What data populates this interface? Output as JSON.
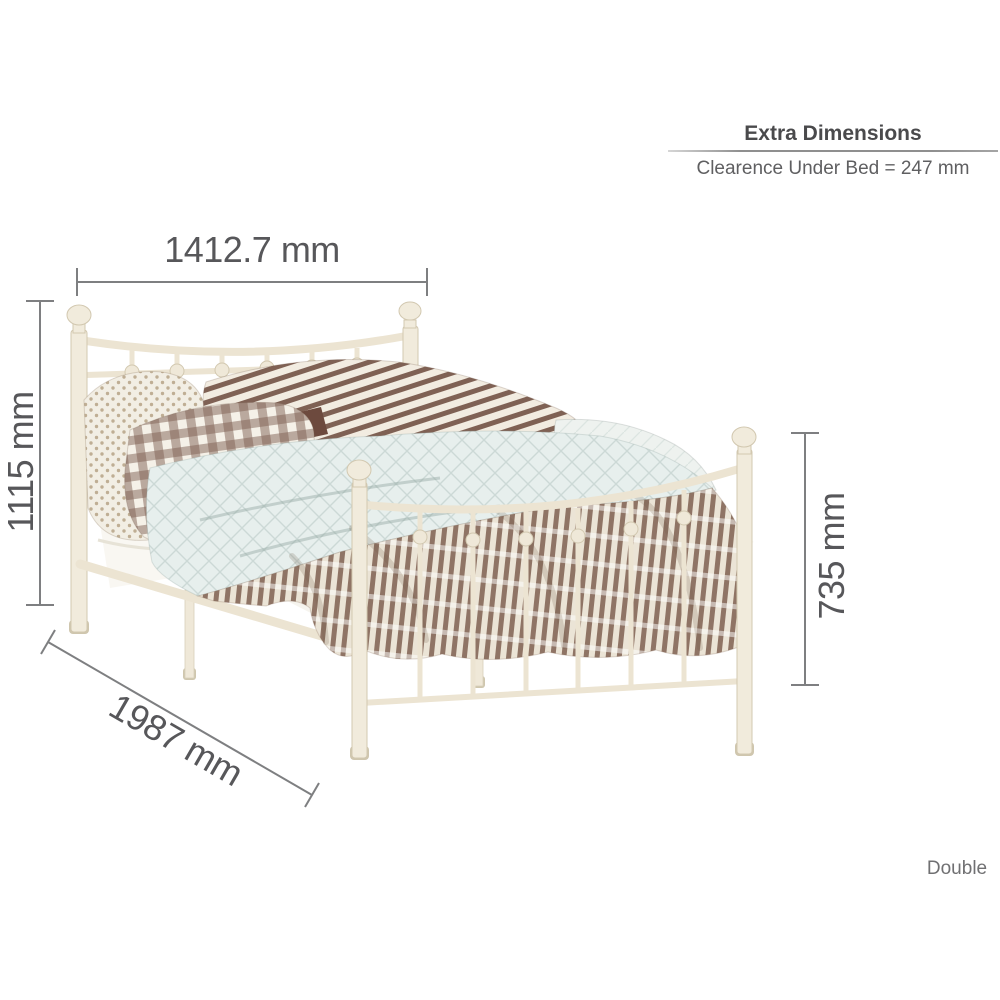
{
  "page": {
    "background_color": "#ffffff",
    "variant_label": "Double"
  },
  "extra_dimensions_panel": {
    "title": "Extra Dimensions",
    "clearance_note": "Clearence Under Bed = 247 mm"
  },
  "dimension_labels": {
    "bed_width": "1412.7 mm",
    "headboard_height": "1115 mm",
    "footboard_height": "735 mm",
    "bed_length": "1987 mm"
  },
  "illustration": {
    "subject": "cream metal double bed frame with striped duvet, check pillows and pale blue quilt",
    "colors": {
      "frame_cream": "#f1ebdc",
      "frame_outline": "#d2c8b0",
      "duvet_stripe_dark": "#8f7465",
      "duvet_stripe_light": "#ebe4d6",
      "pillow_check_brown": "#7f6154",
      "quilt_pale_blue": "#e7efed",
      "accent_maroon": "#6d4a3e",
      "sheet_white": "#f7f5ef"
    }
  },
  "annotation_style": {
    "line_color": "#7e7f81",
    "label_color": "#57575a"
  }
}
